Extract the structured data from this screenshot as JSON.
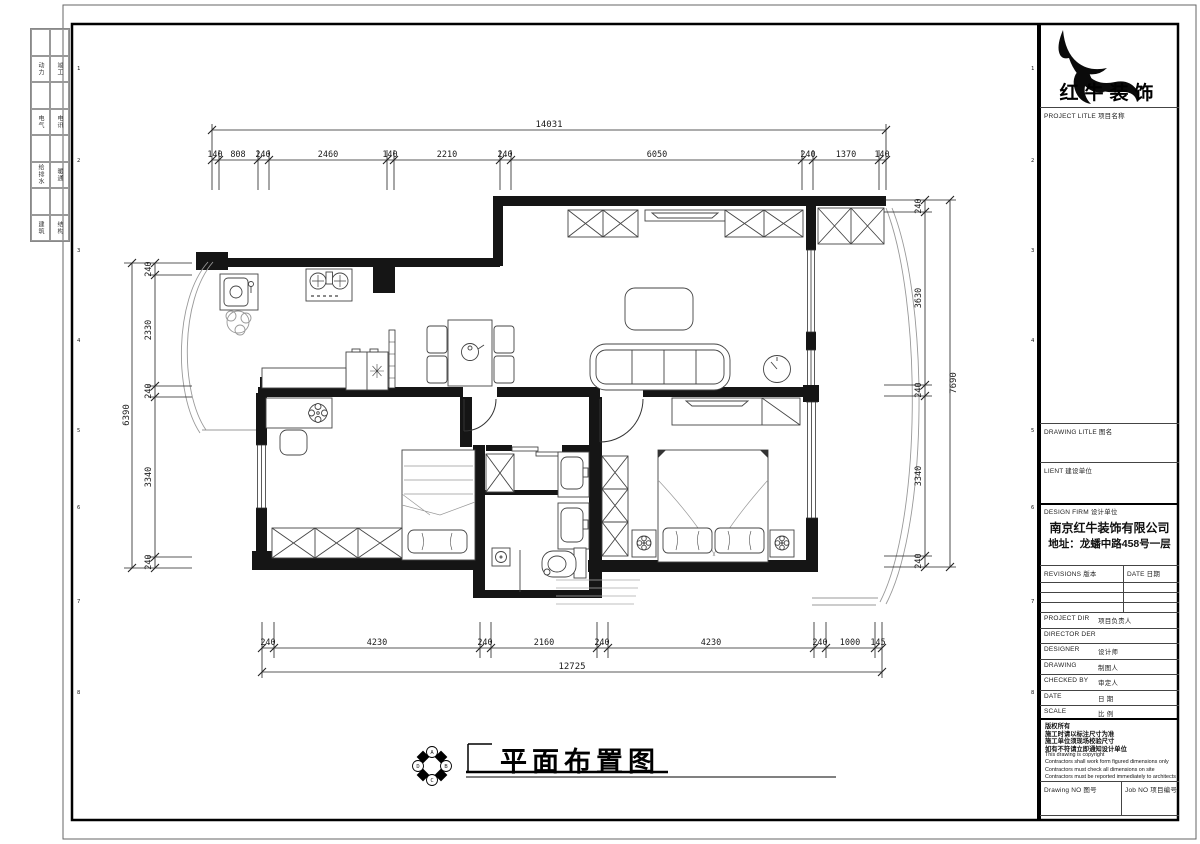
{
  "sheet": {
    "signoff": {
      "rows": [
        [
          "动力",
          "竣工"
        ],
        [
          "电气",
          "电讯"
        ],
        [
          "给排水",
          "暖通"
        ],
        [
          "建筑",
          "结构"
        ]
      ]
    },
    "zone_numbers": [
      "1",
      "2",
      "3",
      "4",
      "5",
      "6",
      "7",
      "8"
    ]
  },
  "title_block": {
    "brand": "红牛装饰",
    "project_title_label": "PROJECT LITLE  项目名称",
    "drawing_title_label": "DRAWING LITLE  图名",
    "client_label": "LIENT  建设单位",
    "design_firm_label": "DESIGN FIRM  设计单位",
    "firm_name": "南京红牛装饰有限公司",
    "firm_address": "地址：龙蟠中路458号一层",
    "revisions_label": "REVISIONS  版本",
    "date_col_label": "DATE  日期",
    "rows": [
      {
        "en": "PROJECT DIR",
        "cn": "项目负责人"
      },
      {
        "en": "DIRECTOR DER",
        "cn": ""
      },
      {
        "en": "DESIGNER",
        "cn": "设计师"
      },
      {
        "en": "DRAWING",
        "cn": "制图人"
      },
      {
        "en": "CHECKED BY",
        "cn": "审定人"
      },
      {
        "en": "DATE",
        "cn": "日  期"
      },
      {
        "en": "SCALE",
        "cn": "比  例"
      }
    ],
    "copyright_cn": [
      "版权所有",
      "施工时请以标注尺寸为准",
      "施工单位须现场校验尺寸",
      "如有不符请立即通知设计单位"
    ],
    "copyright_en": [
      "This drawing is copyright",
      "Contractors shall work form figured dimensions only",
      "Contractors must check all dimensions on site",
      "Contractors must be reported immediately to architects"
    ],
    "drawing_no_label": "Drawing NO  图号",
    "job_no_label": "Job NO  项目编号"
  },
  "drawing": {
    "title": "平面布置图",
    "compass": [
      "A",
      "B",
      "C",
      "D"
    ],
    "dims": {
      "top_overall": "14031",
      "top": [
        "140",
        "808",
        "240",
        "2460",
        "140",
        "2210",
        "240",
        "6050",
        "240",
        "1370",
        "140"
      ],
      "bottom_overall": "12725",
      "bottom": [
        "240",
        "4230",
        "240",
        "2160",
        "240",
        "4230",
        "240",
        "1000",
        "145"
      ],
      "left_overall": "6390",
      "left": [
        "240",
        "2330",
        "240",
        "3340",
        "240"
      ],
      "right_overall": "7690",
      "right": [
        "240",
        "3630",
        "240",
        "3340",
        "240"
      ]
    }
  }
}
